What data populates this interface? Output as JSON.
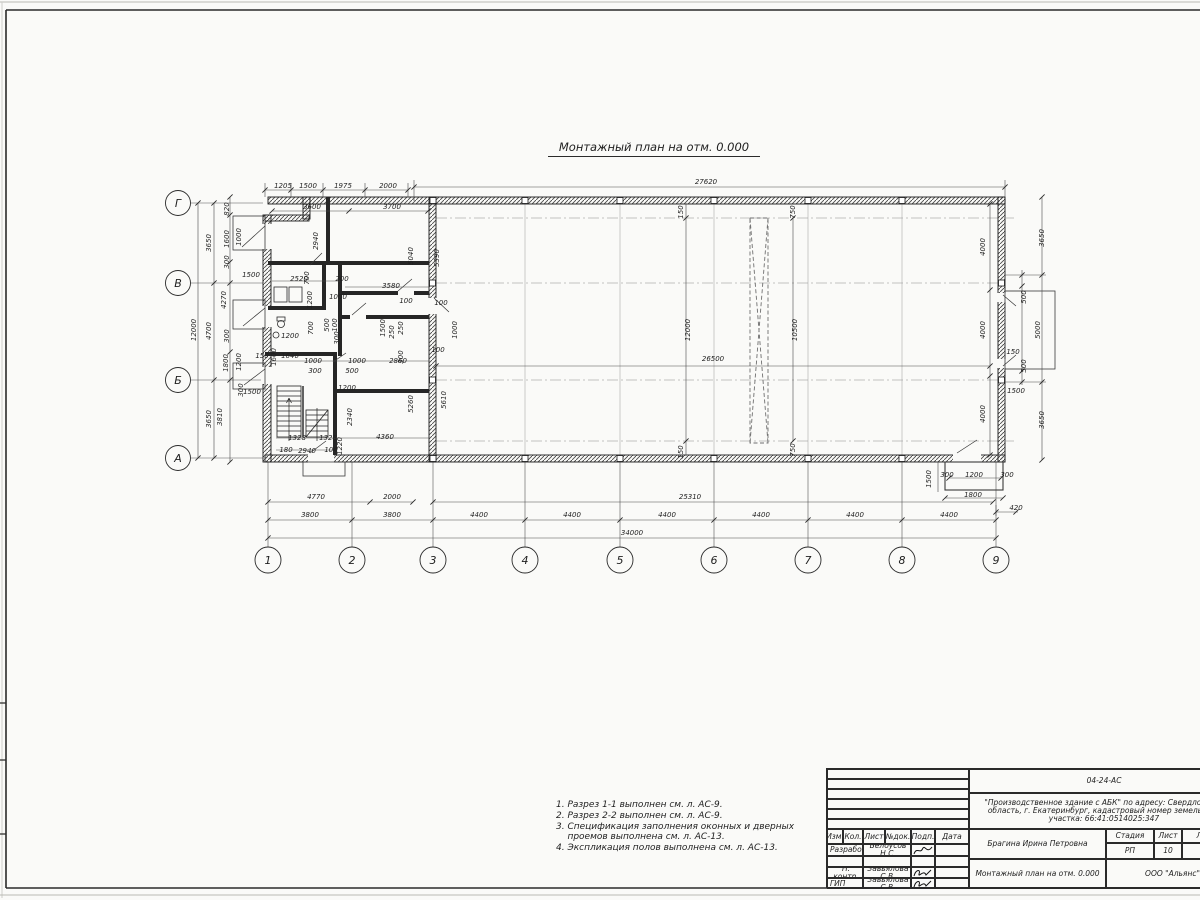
{
  "sheet": {
    "drawing_title": "Монтажный план на отм. 0.000",
    "notes_lines": [
      "1. Разрез 1-1 выполнен см. л. АС-9.",
      "2. Разрез 2-2 выполнен см. л. АС-9.",
      "3. Спецификация заполнения оконных и дверных",
      "    проемов выполнена см. л. АС-13.",
      "4. Экспликация полов выполнена см. л. АС-13."
    ]
  },
  "axes": {
    "rows": [
      {
        "label": "Г",
        "y": 203
      },
      {
        "label": "В",
        "y": 283
      },
      {
        "label": "Б",
        "y": 380
      },
      {
        "label": "А",
        "y": 458
      }
    ],
    "cols": [
      {
        "label": "1",
        "x": 268
      },
      {
        "label": "2",
        "x": 352
      },
      {
        "label": "3",
        "x": 433
      },
      {
        "label": "4",
        "x": 525
      },
      {
        "label": "5",
        "x": 620
      },
      {
        "label": "6",
        "x": 714
      },
      {
        "label": "7",
        "x": 808
      },
      {
        "label": "8",
        "x": 902
      },
      {
        "label": "9",
        "x": 996
      }
    ]
  },
  "dimensions": [
    {
      "t": "1205",
      "x": 283,
      "y": 188,
      "r": 0
    },
    {
      "t": "1500",
      "x": 308,
      "y": 188,
      "r": 0
    },
    {
      "t": "1975",
      "x": 343,
      "y": 188,
      "r": 0
    },
    {
      "t": "2000",
      "x": 388,
      "y": 188,
      "r": 0
    },
    {
      "t": "27620",
      "x": 706,
      "y": 184,
      "r": 0
    },
    {
      "t": "3600",
      "x": 312,
      "y": 209,
      "r": 0
    },
    {
      "t": "3700",
      "x": 392,
      "y": 209,
      "r": 0
    },
    {
      "t": "4770",
      "x": 316,
      "y": 499,
      "r": 0
    },
    {
      "t": "2000",
      "x": 392,
      "y": 499,
      "r": 0
    },
    {
      "t": "25310",
      "x": 690,
      "y": 499,
      "r": 0
    },
    {
      "t": "420",
      "x": 1016,
      "y": 510,
      "r": 0
    },
    {
      "t": "3800",
      "x": 310,
      "y": 517,
      "r": 0
    },
    {
      "t": "3800",
      "x": 392,
      "y": 517,
      "r": 0
    },
    {
      "t": "4400",
      "x": 479,
      "y": 517,
      "r": 0
    },
    {
      "t": "4400",
      "x": 572,
      "y": 517,
      "r": 0
    },
    {
      "t": "4400",
      "x": 667,
      "y": 517,
      "r": 0
    },
    {
      "t": "4400",
      "x": 761,
      "y": 517,
      "r": 0
    },
    {
      "t": "4400",
      "x": 855,
      "y": 517,
      "r": 0
    },
    {
      "t": "4400",
      "x": 949,
      "y": 517,
      "r": 0
    },
    {
      "t": "34000",
      "x": 632,
      "y": 535,
      "r": 0
    },
    {
      "t": "12000",
      "x": 196,
      "y": 330,
      "r": 1
    },
    {
      "t": "3650",
      "x": 211,
      "y": 243,
      "r": 1
    },
    {
      "t": "4700",
      "x": 211,
      "y": 331,
      "r": 1
    },
    {
      "t": "3650",
      "x": 211,
      "y": 419,
      "r": 1
    },
    {
      "t": "3810",
      "x": 222,
      "y": 417,
      "r": 1
    },
    {
      "t": "4270",
      "x": 226,
      "y": 300,
      "r": 1
    },
    {
      "t": "820",
      "x": 229,
      "y": 209,
      "r": 1
    },
    {
      "t": "1600",
      "x": 229,
      "y": 239,
      "r": 1
    },
    {
      "t": "300",
      "x": 229,
      "y": 262,
      "r": 1
    },
    {
      "t": "300",
      "x": 229,
      "y": 336,
      "r": 1
    },
    {
      "t": "1200",
      "x": 241,
      "y": 362,
      "r": 1
    },
    {
      "t": "1800",
      "x": 228,
      "y": 363,
      "r": 1
    },
    {
      "t": "1000",
      "x": 241,
      "y": 237,
      "r": 1
    },
    {
      "t": "300",
      "x": 243,
      "y": 390,
      "r": 1
    },
    {
      "t": "1500",
      "x": 251,
      "y": 277,
      "r": 0
    },
    {
      "t": "1500",
      "x": 252,
      "y": 394,
      "r": 0
    },
    {
      "t": "2940",
      "x": 318,
      "y": 241,
      "r": 1
    },
    {
      "t": "5040",
      "x": 413,
      "y": 256,
      "r": 1
    },
    {
      "t": "5390",
      "x": 439,
      "y": 258,
      "r": 1
    },
    {
      "t": "2520",
      "x": 299,
      "y": 281,
      "r": 0
    },
    {
      "t": "200",
      "x": 342,
      "y": 281,
      "r": 0
    },
    {
      "t": "700",
      "x": 309,
      "y": 278,
      "r": 1
    },
    {
      "t": "1000",
      "x": 338,
      "y": 299,
      "r": 0
    },
    {
      "t": "3580",
      "x": 391,
      "y": 288,
      "r": 0
    },
    {
      "t": "100",
      "x": 406,
      "y": 303,
      "r": 0
    },
    {
      "t": "100",
      "x": 441,
      "y": 305,
      "r": 0
    },
    {
      "t": "1200",
      "x": 312,
      "y": 300,
      "r": 1
    },
    {
      "t": "700",
      "x": 313,
      "y": 328,
      "r": 1
    },
    {
      "t": "500",
      "x": 329,
      "y": 325,
      "r": 1
    },
    {
      "t": "100",
      "x": 337,
      "y": 325,
      "r": 1
    },
    {
      "t": "300",
      "x": 339,
      "y": 338,
      "r": 1
    },
    {
      "t": "1500",
      "x": 385,
      "y": 328,
      "r": 1
    },
    {
      "t": "250",
      "x": 394,
      "y": 332,
      "r": 1
    },
    {
      "t": "250",
      "x": 403,
      "y": 328,
      "r": 1
    },
    {
      "t": "1000",
      "x": 457,
      "y": 330,
      "r": 1
    },
    {
      "t": "100",
      "x": 438,
      "y": 352,
      "r": 0
    },
    {
      "t": "300",
      "x": 403,
      "y": 357,
      "r": 1
    },
    {
      "t": "2860",
      "x": 398,
      "y": 363,
      "r": 0
    },
    {
      "t": "1000",
      "x": 357,
      "y": 363,
      "r": 0
    },
    {
      "t": "500",
      "x": 352,
      "y": 373,
      "r": 0
    },
    {
      "t": "1000",
      "x": 313,
      "y": 363,
      "r": 0
    },
    {
      "t": "300",
      "x": 315,
      "y": 373,
      "r": 0
    },
    {
      "t": "1640",
      "x": 290,
      "y": 358,
      "r": 0
    },
    {
      "t": "1600",
      "x": 276,
      "y": 357,
      "r": 1
    },
    {
      "t": "150",
      "x": 262,
      "y": 358,
      "r": 0
    },
    {
      "t": "1200",
      "x": 290,
      "y": 338,
      "r": 0
    },
    {
      "t": "1200",
      "x": 347,
      "y": 390,
      "r": 0
    },
    {
      "t": "2340",
      "x": 352,
      "y": 417,
      "r": 1
    },
    {
      "t": "1220",
      "x": 342,
      "y": 446,
      "r": 1
    },
    {
      "t": "4360",
      "x": 385,
      "y": 439,
      "r": 0
    },
    {
      "t": "1328",
      "x": 297,
      "y": 440,
      "r": 0
    },
    {
      "t": "1328",
      "x": 328,
      "y": 440,
      "r": 0
    },
    {
      "t": "180",
      "x": 286,
      "y": 452,
      "r": 0
    },
    {
      "t": "2940",
      "x": 307,
      "y": 453,
      "r": 0
    },
    {
      "t": "104",
      "x": 331,
      "y": 452,
      "r": 0
    },
    {
      "t": "5260",
      "x": 413,
      "y": 404,
      "r": 1
    },
    {
      "t": "5610",
      "x": 446,
      "y": 400,
      "r": 1
    },
    {
      "t": "150",
      "x": 683,
      "y": 212,
      "r": 1
    },
    {
      "t": "750",
      "x": 795,
      "y": 212,
      "r": 1
    },
    {
      "t": "12000",
      "x": 690,
      "y": 330,
      "r": 1
    },
    {
      "t": "10500",
      "x": 797,
      "y": 330,
      "r": 1
    },
    {
      "t": "26500",
      "x": 713,
      "y": 361,
      "r": 0
    },
    {
      "t": "150",
      "x": 683,
      "y": 452,
      "r": 1
    },
    {
      "t": "750",
      "x": 795,
      "y": 450,
      "r": 1
    },
    {
      "t": "4000",
      "x": 985,
      "y": 247,
      "r": 1
    },
    {
      "t": "4000",
      "x": 985,
      "y": 330,
      "r": 1
    },
    {
      "t": "4000",
      "x": 985,
      "y": 414,
      "r": 1
    },
    {
      "t": "3650",
      "x": 1044,
      "y": 238,
      "r": 1
    },
    {
      "t": "5000",
      "x": 1040,
      "y": 330,
      "r": 1
    },
    {
      "t": "3650",
      "x": 1044,
      "y": 420,
      "r": 1
    },
    {
      "t": "500",
      "x": 1026,
      "y": 297,
      "r": 1
    },
    {
      "t": "500",
      "x": 1026,
      "y": 366,
      "r": 1
    },
    {
      "t": "150",
      "x": 1013,
      "y": 354,
      "r": 0
    },
    {
      "t": "1500",
      "x": 1016,
      "y": 393,
      "r": 0
    },
    {
      "t": "1500",
      "x": 931,
      "y": 479,
      "r": 1
    },
    {
      "t": "300",
      "x": 947,
      "y": 477,
      "r": 0
    },
    {
      "t": "1200",
      "x": 974,
      "y": 477,
      "r": 0
    },
    {
      "t": "300",
      "x": 1007,
      "y": 477,
      "r": 0
    },
    {
      "t": "1800",
      "x": 973,
      "y": 497,
      "r": 0
    }
  ],
  "title_block": {
    "code": "04-24-АС",
    "project_line1": "\"Производственное здание с АБК\" по адресу: Свердловская",
    "project_line2": "область, г. Екатеринбург, кадастровый номер земельного",
    "project_line3": "участка: 66:41:0514025:347",
    "columns": [
      "Изм.",
      "Кол.",
      "Лист",
      "№док.",
      "Подп.",
      "Дата"
    ],
    "rows": [
      {
        "role": "Разработал",
        "name": "Белоусов Н.С."
      },
      {
        "role": "",
        "name": ""
      },
      {
        "role": "Н. контр.",
        "name": "Завьялова С.В."
      },
      {
        "role": "ГИП",
        "name": "Завьялова С.В."
      }
    ],
    "customer": "Брагина Ирина Петровна",
    "sheet_title": "Монтажный план на отм. 0.000",
    "stage_label": "Стадия",
    "sheet_label": "Лист",
    "sheets_label": "Листов",
    "stage": "РП",
    "sheet_no": "10",
    "sheets_total": "13",
    "company": "ООО \"Альянс\""
  }
}
